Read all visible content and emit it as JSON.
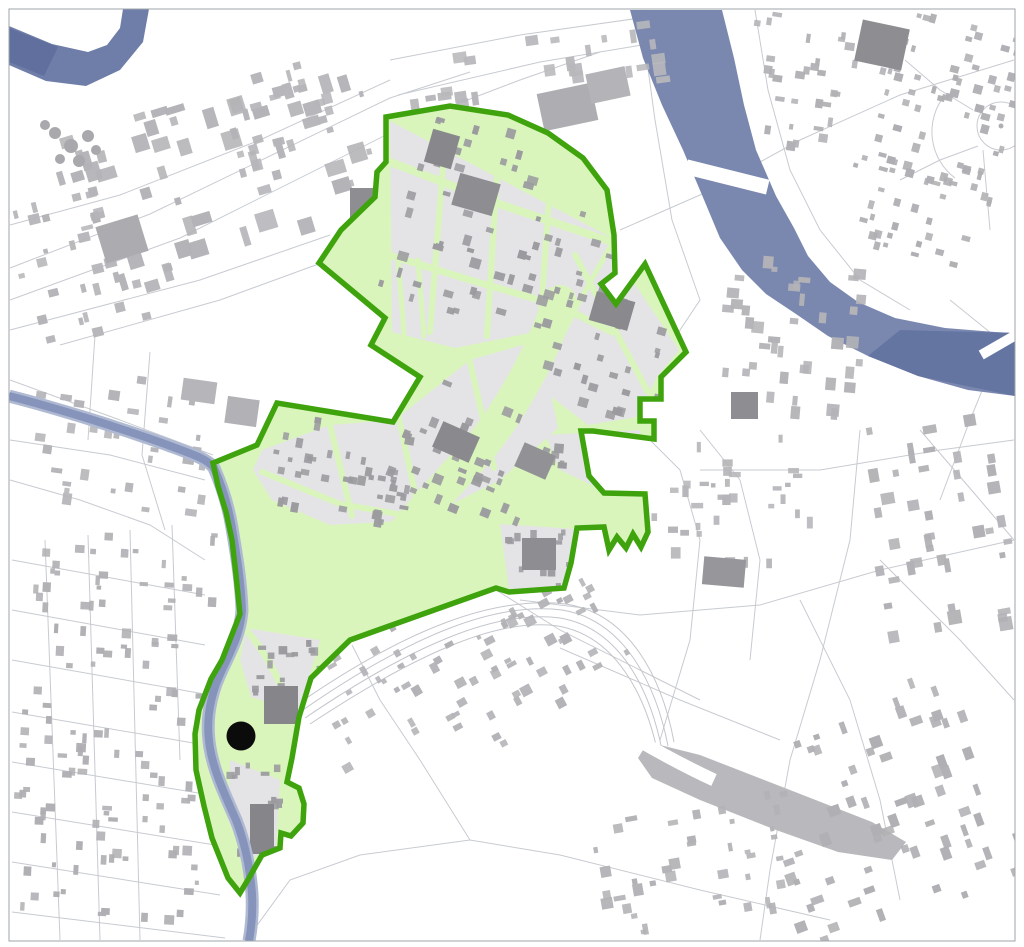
{
  "map": {
    "colors": {
      "background": "#ffffff",
      "frame_line": "#9FA5AB",
      "road": "#C7CBD1",
      "rail": "#C2C6CB",
      "rail_yard": "#B9B9BD",
      "river_main": "#7A88B0",
      "river_dark": "#62729F",
      "river_upper_left": "#6F7EA8",
      "river_upper_left_dark": "#5E6E9C",
      "stream_edge": "#AFBAD2",
      "stream_core": "#8694BC",
      "zone_fill": "#D9F5BC",
      "zone_boundary": "#3FA30D",
      "zone_block": "#E4E4E6",
      "building_interior": "#9B9B9F",
      "marker": "#0B0B0B"
    },
    "frame": {
      "x": 9,
      "y": 9,
      "w": 1006,
      "h": 932
    },
    "marker": {
      "cx": 241,
      "cy": 736,
      "r": 14.5
    },
    "zone": {
      "boundary_path": "M386,117 L450,106 L508,115 L548,133 L583,158 L607,190 L614,235 L615,273 L601,284 L616,304 L645,264 L686,352 L661,377 L661,399 L640,399 L640,421 L654,421 L654,439 L593,431 L581,431 L589,476 L604,493 L645,494 L648,532 L641,547 L633,534 L626,548 L617,537 L609,550 L604,527 L577,528 L571,563 L564,588 L509,592 L496,588 L350,640 L311,678 L299,717 L292,758 L287,782 L299,788 L304,804 L303,823 L291,836 L281,833 L280,848 L262,855 L249,878 L240,893 L228,878 L212,838 L204,806 L196,770 L195,734 L199,710 L211,679 L222,660 L240,614 L236,575 L232,540 L226,512 L218,486 L213,463 L257,445 L277,403 L393,422 L420,377 L371,345 L385,318 L319,263 L341,230 L375,197 L377,172 L386,162 Z",
      "stroke_width": 5.5
    },
    "rivers": {
      "main_path": "M630,10 L643,58 L662,105 L683,150 L702,195 L720,238 L742,270 L766,294 L796,314 L828,336 L868,356 L918,376 L968,390 L1015,396 L1015,333 L995,332 L945,328 L895,318 L858,302 L830,282 L808,256 L794,228 L776,196 L756,150 L744,105 L734,58 L722,10 Z",
      "main_dark_overlay": "M900,330 L1015,333 L1015,396 L918,376 L868,356 Z",
      "upper_left_path": "M9,26 L52,44 L88,52 L107,45 L120,28 L123,9 L149,9 L143,42 L120,70 L86,86 L46,81 L9,65 Z",
      "upper_left_dark": "M9,28 L58,47 L44,76 L9,62 Z",
      "stream_path": "M9,396 C60,409 120,428 165,444 C192,454 208,459 214,468 C222,486 228,504 232,528 C236,552 241,580 242,610 C240,640 226,658 216,684 C209,704 206,724 210,748 C214,772 225,795 236,820 C245,843 250,866 252,894 C253,914 251,930 249,941"
    },
    "bridges": [
      {
        "cx": 727,
        "cy": 177,
        "w": 84,
        "h": 15,
        "a": 14
      },
      {
        "cx": 1002,
        "cy": 343,
        "w": 48,
        "h": 10,
        "a": -30
      }
    ],
    "rail": {
      "yard_path": "M648,742 L700,755 L790,790 L872,822 L906,842 L892,860 L838,852 L776,830 L700,800 L652,778 L638,758 Z",
      "tracks": [
        "M305,718 C420,640 500,610 560,618 C620,628 650,690 662,750",
        "M310,724 C425,648 502,618 558,626 C616,636 646,696 658,754",
        "M300,712 C415,632 498,602 562,610 C624,620 656,684 668,746",
        "M295,706 C410,626 496,596 566,604 C630,614 662,678 674,742"
      ],
      "avenue": "M550,686 C606,722 662,756 714,780"
    },
    "roads": [
      "M10,300 L180,238 L420,118 L520,80 L600,52",
      "M10,268 L150,214 L390,98 L470,72",
      "M10,330 L200,280 L330,235",
      "M60,345 L220,300 L335,258",
      "M390,60 L520,35 L640,18",
      "M398,95 L540,62 L660,42",
      "M10,225 L120,195 L260,140 L390,80",
      "M10,380 L120,420 L213,455",
      "M10,440 L110,455 L205,480",
      "M95,335 L88,440",
      "M150,352 L142,455 L165,530",
      "M10,480 L80,500 L150,525 L205,560",
      "M45,540 L60,940",
      "M88,535 L100,940",
      "M130,530 L140,940",
      "M172,525 L180,760",
      "M12,560 L205,595",
      "M12,610 L205,645",
      "M12,660 L210,695",
      "M12,712 L205,745",
      "M12,762 L210,795",
      "M12,812 L215,845",
      "M12,862 L220,895",
      "M12,912 L225,938",
      "M250,935 L290,880 L360,855 L470,840 L560,855 L700,890 L830,920",
      "M470,840 L420,760 L380,700 L352,645",
      "M496,590 L560,630 L640,670 L700,700",
      "M520,600 L640,615 L760,605 L880,570 L1014,540",
      "M560,648 L680,700 L780,740",
      "M640,430 L680,470 L700,540 L690,640 L660,740",
      "M700,430 L740,480 L760,560 L750,660",
      "M860,430 L850,540 L820,660 L790,760 L770,870 L760,940",
      "M700,470 L820,470 L940,450 L1014,440",
      "M920,430 L980,500 L1014,540",
      "M880,560 L960,640 L1014,700",
      "M800,600 L850,700 L880,800 L900,900",
      "M620,230 L700,195 L800,140 L900,95 L1014,60",
      "M640,10 L655,120 L672,220 L700,300 L660,360 L620,420",
      "M755,10 L768,90 L790,170 L820,230 L860,280 L910,310",
      "M950,300 L1002,342 L1014,352",
      "M1002,342 L970,420 L940,500",
      "M905,60 L940,90 L973,110",
      "M900,180 L940,160 L978,146",
      "M983,150 L990,230",
      "M945,95 A58,58 0 0,0 955,178"
    ],
    "plaza": {
      "cx": 1001,
      "cy": 126,
      "r": 24
    },
    "gray_blocks": [
      "M390,121 L612,238 L614,302 L545,330 L455,348 L392,332 Z",
      "M553,255 L610,247 L679,350 L657,377 L637,417 L588,425 L549,395 L545,335 Z",
      "M262,450 L330,425 L395,420 L470,360 L540,340 L558,428 L500,480 L420,520 L330,525 L272,500 L253,470 Z",
      "M545,435 L640,430 L646,492 L606,492 L560,470 Z",
      "M500,524 L575,529 L566,586 L509,590 Z",
      "M246,628 L320,640 L305,690 L300,720 L252,700 L240,660 Z",
      "M230,760 L280,780 L276,846 L248,860 L228,820 Z"
    ],
    "green_streets": [
      {
        "d": "M385,160 L505,206 L612,242",
        "w": 8
      },
      {
        "d": "M392,256 L470,280 L560,306 L612,332",
        "w": 7
      },
      {
        "d": "M446,128 L430,332",
        "w": 6
      },
      {
        "d": "M500,126 L487,336",
        "w": 6
      },
      {
        "d": "M553,140 L540,330",
        "w": 6
      },
      {
        "d": "M398,258 L404,334",
        "w": 5
      },
      {
        "d": "M418,260 L424,336",
        "w": 5
      },
      {
        "d": "M575,255 L648,392",
        "w": 6
      },
      {
        "d": "M610,247 L580,300 L560,340",
        "w": 5
      },
      {
        "d": "M560,302 C538,362 504,426 458,472 C418,516 378,562 332,626",
        "w": 34
      },
      {
        "d": "M262,472 L340,504 L432,520 L475,512",
        "w": 6
      },
      {
        "d": "M330,425 L352,516",
        "w": 6
      },
      {
        "d": "M398,414 L420,516",
        "w": 6
      },
      {
        "d": "M470,362 L494,468",
        "w": 6
      },
      {
        "d": "M246,630 C272,660 292,700 299,754",
        "w": 7
      },
      {
        "d": "M253,700 L300,717",
        "w": 5
      }
    ],
    "districts_exterior": [
      {
        "x": 55,
        "y": 85,
        "w": 330,
        "h": 185,
        "a": -17,
        "n": 60,
        "smin": 6,
        "smax": 20,
        "fill": "#B3B3B7"
      },
      {
        "x": 390,
        "y": 35,
        "w": 290,
        "h": 70,
        "a": -8,
        "n": 26,
        "smin": 5,
        "smax": 14,
        "fill": "#B8B8BC"
      },
      {
        "x": 745,
        "y": 15,
        "w": 110,
        "h": 140,
        "a": 8,
        "n": 30,
        "smin": 4,
        "smax": 10,
        "fill": "#B1B1B5"
      },
      {
        "x": 862,
        "y": 15,
        "w": 145,
        "h": 250,
        "a": 15,
        "n": 95,
        "smin": 4,
        "smax": 9,
        "fill": "#AFAFB3"
      },
      {
        "x": 700,
        "y": 255,
        "w": 170,
        "h": 165,
        "a": 5,
        "n": 40,
        "smin": 5,
        "smax": 13,
        "fill": "#B3B3B7"
      },
      {
        "x": 865,
        "y": 415,
        "w": 145,
        "h": 230,
        "a": -10,
        "n": 42,
        "smin": 5,
        "smax": 14,
        "fill": "#B1B1B5"
      },
      {
        "x": 630,
        "y": 430,
        "w": 190,
        "h": 140,
        "a": 0,
        "n": 36,
        "smin": 4,
        "smax": 12,
        "fill": "#B5B5B9"
      },
      {
        "x": 420,
        "y": 600,
        "w": 210,
        "h": 130,
        "a": -28,
        "n": 48,
        "smin": 4,
        "smax": 11,
        "fill": "#B2B2B6"
      },
      {
        "x": 760,
        "y": 690,
        "w": 245,
        "h": 240,
        "a": -20,
        "n": 65,
        "smin": 5,
        "smax": 13,
        "fill": "#B0B0B4"
      },
      {
        "x": 15,
        "y": 525,
        "w": 195,
        "h": 405,
        "a": 3,
        "n": 120,
        "smin": 4,
        "smax": 10,
        "fill": "#AFAFB3"
      },
      {
        "x": 15,
        "y": 370,
        "w": 200,
        "h": 145,
        "a": 8,
        "n": 34,
        "smin": 4,
        "smax": 12,
        "fill": "#B4B4B8"
      },
      {
        "x": 12,
        "y": 140,
        "w": 125,
        "h": 210,
        "a": -14,
        "n": 30,
        "smin": 4,
        "smax": 12,
        "fill": "#B5B5B9"
      },
      {
        "x": 300,
        "y": 635,
        "w": 150,
        "h": 115,
        "a": -30,
        "n": 26,
        "smin": 4,
        "smax": 10,
        "fill": "#B3B3B7"
      },
      {
        "x": 585,
        "y": 790,
        "w": 220,
        "h": 140,
        "a": -10,
        "n": 40,
        "smin": 4,
        "smax": 12,
        "fill": "#B2B2B6"
      },
      {
        "x": 225,
        "y": 55,
        "w": 150,
        "h": 120,
        "a": -15,
        "n": 22,
        "smin": 4,
        "smax": 12,
        "fill": "#B6B6BA"
      }
    ],
    "districts_interior": [
      {
        "x": 398,
        "y": 128,
        "w": 205,
        "h": 200,
        "a": 16,
        "n": 64,
        "smin": 4,
        "smax": 11,
        "fill": "#9B9B9F"
      },
      {
        "x": 552,
        "y": 252,
        "w": 125,
        "h": 170,
        "a": 16,
        "n": 32,
        "smin": 4,
        "smax": 10,
        "fill": "#9B9B9F"
      },
      {
        "x": 262,
        "y": 422,
        "w": 165,
        "h": 100,
        "a": 10,
        "n": 40,
        "smin": 4,
        "smax": 10,
        "fill": "#9B9B9F"
      },
      {
        "x": 398,
        "y": 392,
        "w": 150,
        "h": 125,
        "a": 22,
        "n": 34,
        "smin": 4,
        "smax": 10,
        "fill": "#9B9B9F"
      },
      {
        "x": 545,
        "y": 430,
        "w": 100,
        "h": 65,
        "a": 5,
        "n": 18,
        "smin": 4,
        "smax": 10,
        "fill": "#9B9B9F"
      },
      {
        "x": 502,
        "y": 526,
        "w": 72,
        "h": 62,
        "a": 0,
        "n": 13,
        "smin": 4,
        "smax": 9,
        "fill": "#9B9B9F"
      },
      {
        "x": 245,
        "y": 622,
        "w": 90,
        "h": 100,
        "a": 0,
        "n": 22,
        "smin": 4,
        "smax": 9,
        "fill": "#9B9B9F"
      },
      {
        "x": 226,
        "y": 752,
        "w": 60,
        "h": 110,
        "a": 0,
        "n": 18,
        "smin": 4,
        "smax": 9,
        "fill": "#9B9B9F"
      }
    ],
    "landmarks_interior": [
      {
        "x": 428,
        "y": 132,
        "w": 28,
        "h": 34,
        "a": 16,
        "fill": "#88888C"
      },
      {
        "x": 455,
        "y": 178,
        "w": 42,
        "h": 33,
        "a": 16,
        "fill": "#8E8E92"
      },
      {
        "x": 592,
        "y": 296,
        "w": 40,
        "h": 30,
        "a": 16,
        "fill": "#8A8A8E"
      },
      {
        "x": 436,
        "y": 428,
        "w": 40,
        "h": 28,
        "a": 24,
        "fill": "#8A8A8E"
      },
      {
        "x": 518,
        "y": 448,
        "w": 34,
        "h": 26,
        "a": 24,
        "fill": "#929296"
      },
      {
        "x": 522,
        "y": 538,
        "w": 34,
        "h": 32,
        "a": 0,
        "fill": "#8E8E92"
      },
      {
        "x": 264,
        "y": 686,
        "w": 34,
        "h": 38,
        "a": 0,
        "fill": "#85858A"
      },
      {
        "x": 250,
        "y": 804,
        "w": 24,
        "h": 50,
        "a": 0,
        "fill": "#85858A"
      }
    ],
    "landmarks_exterior": [
      {
        "x": 350,
        "y": 188,
        "w": 42,
        "h": 40,
        "a": 0,
        "fill": "#8E8E92"
      },
      {
        "x": 858,
        "y": 24,
        "w": 48,
        "h": 42,
        "a": 12,
        "fill": "#8E8E92"
      },
      {
        "x": 100,
        "y": 220,
        "w": 44,
        "h": 38,
        "a": -17,
        "fill": "#ACACB0"
      },
      {
        "x": 182,
        "y": 380,
        "w": 34,
        "h": 22,
        "a": 8,
        "fill": "#B6B6BA"
      },
      {
        "x": 226,
        "y": 398,
        "w": 32,
        "h": 27,
        "a": 8,
        "fill": "#B2B2B6"
      },
      {
        "x": 731,
        "y": 392,
        "w": 27,
        "h": 27,
        "a": 0,
        "fill": "#8E8E92"
      },
      {
        "x": 703,
        "y": 558,
        "w": 42,
        "h": 28,
        "a": 5,
        "fill": "#97979B"
      },
      {
        "x": 540,
        "y": 88,
        "w": 55,
        "h": 38,
        "a": -12,
        "fill": "#AEAEB2"
      },
      {
        "x": 588,
        "y": 70,
        "w": 40,
        "h": 30,
        "a": -12,
        "fill": "#B4B4B8"
      }
    ],
    "clarifier_tanks": [
      {
        "cx": 55,
        "cy": 133,
        "r": 6
      },
      {
        "cx": 71,
        "cy": 146,
        "r": 7
      },
      {
        "cx": 88,
        "cy": 136,
        "r": 6
      },
      {
        "cx": 60,
        "cy": 159,
        "r": 5
      },
      {
        "cx": 79,
        "cy": 161,
        "r": 6
      },
      {
        "cx": 96,
        "cy": 150,
        "r": 5
      },
      {
        "cx": 45,
        "cy": 125,
        "r": 5
      }
    ]
  }
}
